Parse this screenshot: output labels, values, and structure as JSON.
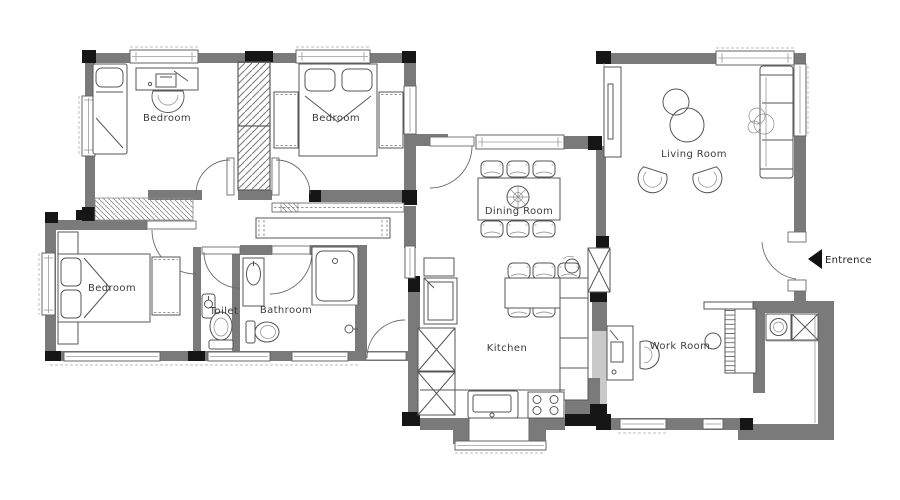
{
  "floor_plan": {
    "labels": {
      "bedroom_top_left": "Bedroom",
      "bedroom_top_middle": "Bedroom",
      "bedroom_bottom_left": "Bedroom",
      "toilet": "Toilet",
      "bathroom": "Bathroom",
      "dining_room": "Dining Room",
      "kitchen": "Kitchen",
      "living_room": "Living Room",
      "work_room": "Work Room",
      "entrance": "Entrence"
    },
    "colors": {
      "wall": "#7a7a7a",
      "column": "#161616",
      "light_block": "#c9c9c9",
      "furniture_line": "#555555",
      "background": "#ffffff"
    }
  }
}
